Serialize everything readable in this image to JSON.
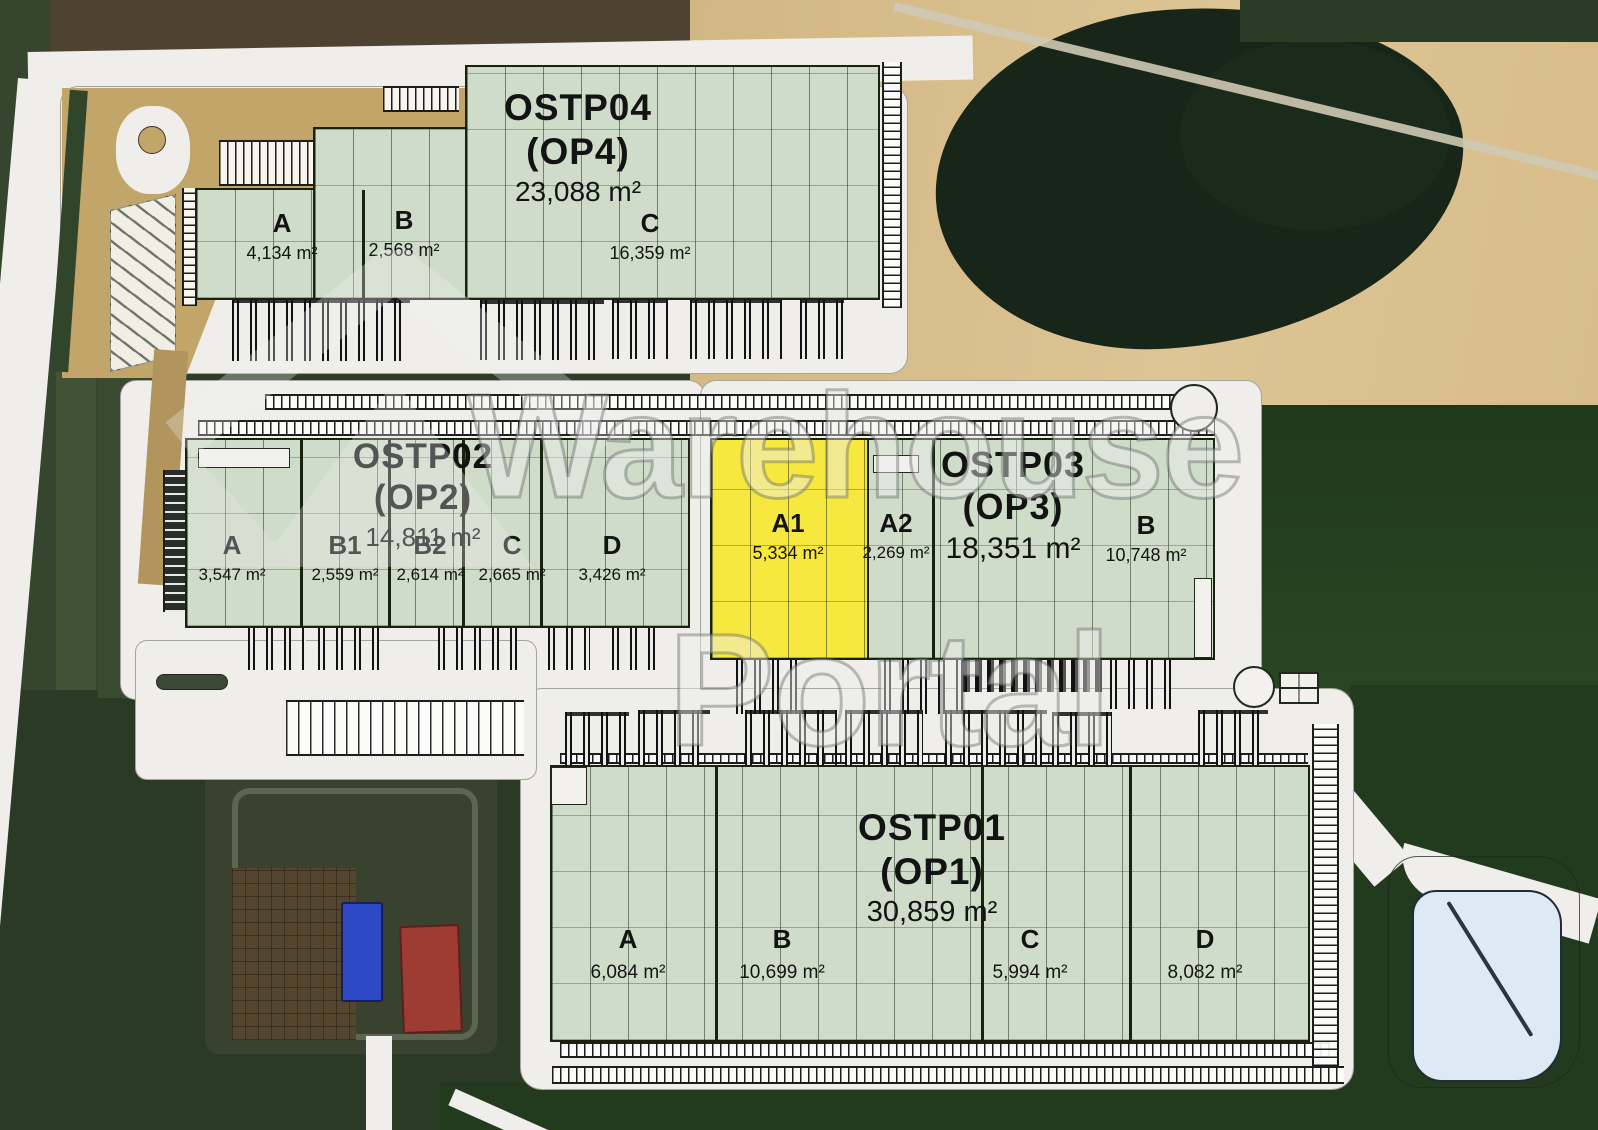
{
  "watermark": {
    "line1": "Warehouse",
    "line2": "Portal"
  },
  "colors": {
    "available": "#cfdcc9",
    "highlighted": "#f6e83e",
    "pond": "#dde9f4"
  },
  "buildings": [
    {
      "id": "OSTP04",
      "title": "OSTP04",
      "subtitle": "(OP4)",
      "area": "23,088 m²",
      "sections": [
        {
          "label": "A",
          "area": "4,134 m²"
        },
        {
          "label": "B",
          "area": "2,568 m²"
        },
        {
          "label": "C",
          "area": "16,359 m²"
        }
      ]
    },
    {
      "id": "OSTP02",
      "title": "OSTP02",
      "subtitle": "(OP2)",
      "area": "14,811 m²",
      "sections": [
        {
          "label": "A",
          "area": "3,547 m²"
        },
        {
          "label": "B1",
          "area": "2,559 m²"
        },
        {
          "label": "B2",
          "area": "2,614 m²"
        },
        {
          "label": "C",
          "area": "2,665 m²"
        },
        {
          "label": "D",
          "area": "3,426 m²"
        }
      ]
    },
    {
      "id": "OSTP03",
      "title": "OSTP03",
      "subtitle": "(OP3)",
      "area": "18,351 m²",
      "sections": [
        {
          "label": "A1",
          "area": "5,334 m²",
          "highlighted": true
        },
        {
          "label": "A2",
          "area": "2,269 m²"
        },
        {
          "label": "B",
          "area": "10,748 m²"
        }
      ]
    },
    {
      "id": "OSTP01",
      "title": "OSTP01",
      "subtitle": "(OP1)",
      "area": "30,859 m²",
      "sections": [
        {
          "label": "A",
          "area": "6,084 m²"
        },
        {
          "label": "B",
          "area": "10,699 m²"
        },
        {
          "label": "C",
          "area": "5,994 m²"
        },
        {
          "label": "D",
          "area": "8,082 m²"
        }
      ]
    }
  ]
}
